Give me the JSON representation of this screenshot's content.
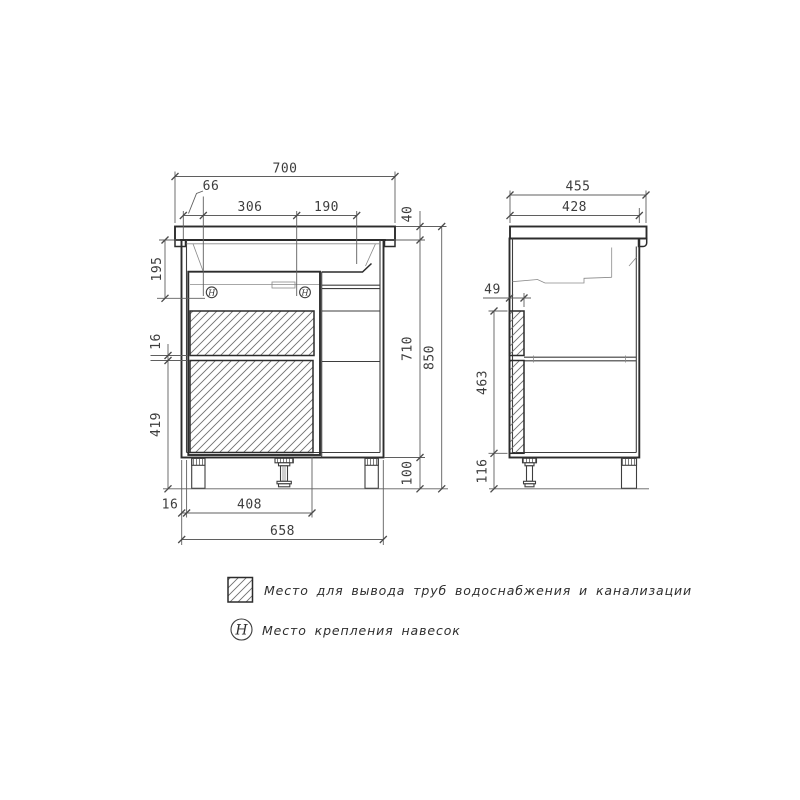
{
  "front": {
    "overall_width": "700",
    "hinge_offset": "66",
    "hinge_spacing": "306",
    "hinge_to_basin": "190",
    "top_thickness": "40",
    "top_to_hinge": "195",
    "panel_gap": "16",
    "lower_zone_height": "419",
    "body_height": "710",
    "total_height": "850",
    "leg_height": "100",
    "wall_thickness": "16",
    "opening_width": "408",
    "body_width": "658",
    "hinge_mark": "H"
  },
  "side": {
    "overall_depth": "455",
    "body_depth": "428",
    "pipe_zone_width": "49",
    "pipe_zone_height": "463",
    "bottom_clearance": "116"
  },
  "legend": {
    "pipe_zone": "Место для вывода труб водоснабжения и канализации",
    "hinge": "Место крепления навесок",
    "hinge_mark": "H"
  },
  "colors": {
    "background": "#ffffff",
    "line": "#2c2c2c",
    "dim": "#5f5f5f"
  }
}
